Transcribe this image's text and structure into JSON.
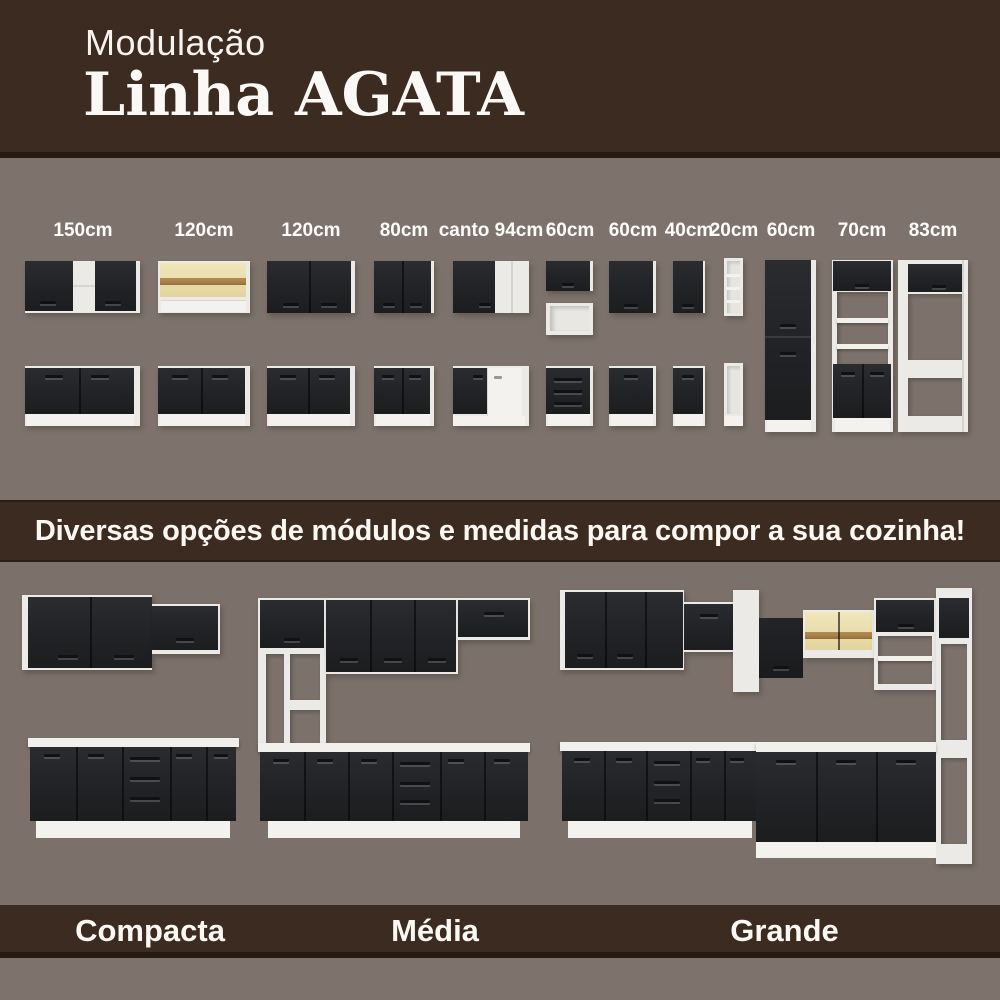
{
  "header": {
    "kicker": "Modulação",
    "title": "Linha AGATA"
  },
  "modules": {
    "labels": [
      "150cm",
      "120cm",
      "120cm",
      "80cm",
      "canto 94cm",
      "60cm",
      "60cm",
      "40cm",
      "20cm",
      "60cm",
      "70cm",
      "83cm"
    ]
  },
  "banner": {
    "text": "Diversas opções de módulos e medidas para compor a sua cozinha!"
  },
  "kitchens": {
    "sizes": [
      {
        "name": "Compacta"
      },
      {
        "name": "Média"
      },
      {
        "name": "Grande"
      }
    ]
  },
  "colors": {
    "brown_band": "#3b2b21",
    "background_taupe": "#7d736c",
    "cabinet_black": "#232427",
    "carcass_white": "#eceae7",
    "glass_yellow": "#e8dca8",
    "wood_band": "#a87f4a",
    "text_white": "#fbf8f4"
  }
}
